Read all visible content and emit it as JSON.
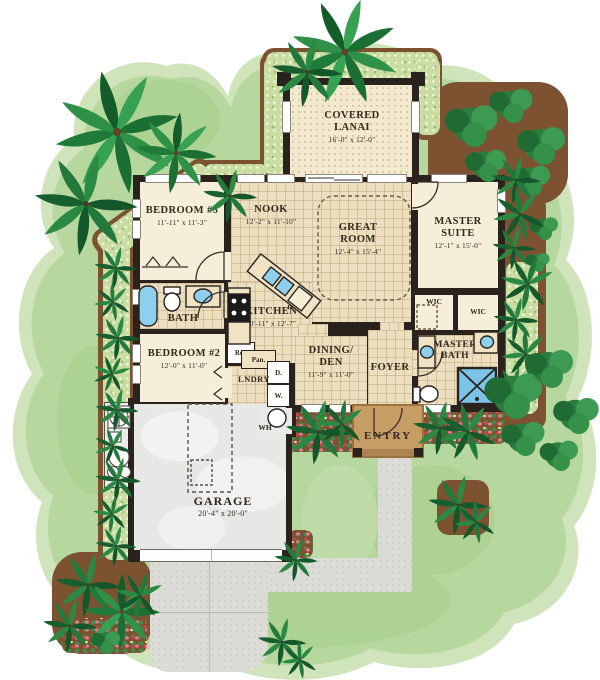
{
  "plan": {
    "rooms": {
      "lanai": {
        "name": "COVERED LANAI",
        "dims": "16'-0\" x 12'-0\""
      },
      "bedroom3": {
        "name": "BEDROOM #3",
        "dims": "11'-11\" x 11'-3\""
      },
      "nook": {
        "name": "NOOK",
        "dims": "12'-2\" x 11'-10\""
      },
      "great_room": {
        "name": "GREAT ROOM",
        "dims": "12'-4\" x 15'-4\""
      },
      "master_suite": {
        "name": "MASTER SUITE",
        "dims": "12'-1\" x 15'-0\""
      },
      "bath": {
        "name": "BATH"
      },
      "kitchen": {
        "name": "KITCHEN",
        "dims": "10'-11\" x 12'-7\""
      },
      "bedroom2": {
        "name": "BEDROOM #2",
        "dims": "12'-0\" x 11'-0\""
      },
      "laundry": {
        "name": "LNDRY"
      },
      "dining_den": {
        "name": "DINING/ DEN",
        "dims": "11'-9\" x 11'-0\""
      },
      "foyer": {
        "name": "FOYER"
      },
      "wic": {
        "name": "WIC"
      },
      "master_bath": {
        "name": "MASTER BATH"
      },
      "entry": {
        "name": "ENTRY"
      },
      "garage": {
        "name": "GARAGE",
        "dims": "20'-4\" x 20'-0\""
      }
    },
    "fixtures": {
      "refrigerator": "Ref.",
      "pantry": "Pan.",
      "dishwasher": "DW",
      "dryer": "D.",
      "washer": "W.",
      "water_heater": "WH"
    },
    "colors": {
      "lawn": "#b6d79e",
      "lawn_light": "#cfe4bb",
      "walls": "#2a221c",
      "floor": "#f6eed8",
      "tile": "#ecdfc0",
      "hardscape": "#dcdcd7",
      "entry_stoop": "#c79d66",
      "mulch": "#7c5230",
      "water_fixture": "#8ecfed"
    }
  }
}
